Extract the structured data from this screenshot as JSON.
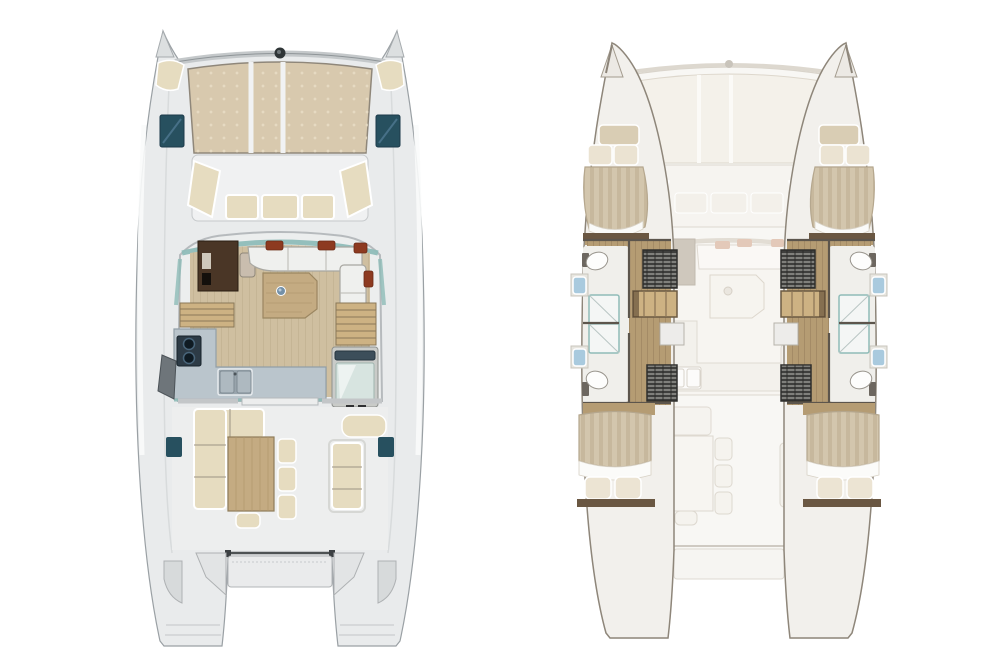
{
  "figure": {
    "type": "catamaran-floorplan",
    "views": [
      {
        "id": "deck-level",
        "elements": [
          "bow-trampoline",
          "crossbeam",
          "bow-seats",
          "deck-hatches",
          "forward-cockpit-seating",
          "saloon",
          "nav-station",
          "u-sofa",
          "coffee-table",
          "galley-counter",
          "stove",
          "double-sink",
          "companionway-steps",
          "fridge-unit",
          "sliding-door",
          "aft-cockpit-sofa",
          "dining-table",
          "stools",
          "aft-bench",
          "helm-seat",
          "stern-davit",
          "stern-platform"
        ]
      },
      {
        "id": "hull-level",
        "elements": [
          "ghost-deck",
          "port-hull",
          "starboard-hull",
          "bow-cabin-bed",
          "aft-cabin-bed",
          "pillows",
          "toilet",
          "washbasin",
          "shower",
          "wardrobe",
          "hull-steps"
        ]
      }
    ],
    "palette": {
      "deck": "#e9ebec",
      "deck-line": "#9aa0a4",
      "tramp": "#d8c9ae",
      "tramp-dot": "#eadfc8",
      "hatch": "#27505f",
      "cushion": "#e6dcc0",
      "cushion-line": "#9c9384",
      "glass": "#8fbcb8",
      "saloon-wood": "#cfbfa0",
      "nav-desk": "#4a3626",
      "counter": "#bac5cc",
      "pillow": "#8d3a20",
      "table-wood": "#c4ab82",
      "step-wood": "#cdb283",
      "hull-wood": "#b59c73",
      "dark-wood": "#6a5742",
      "sink-blue": "#a9cade",
      "sofa-white": "#eff0ee",
      "stove": "#2d3b46",
      "wardrobe": "#3f3f3d",
      "ghost-deck": "#f8f7f4",
      "ghost-line": "#d9d4cb",
      "ghost-fill": "#f3f0ea",
      "ghost-pillow": "#e3c9b9"
    }
  }
}
